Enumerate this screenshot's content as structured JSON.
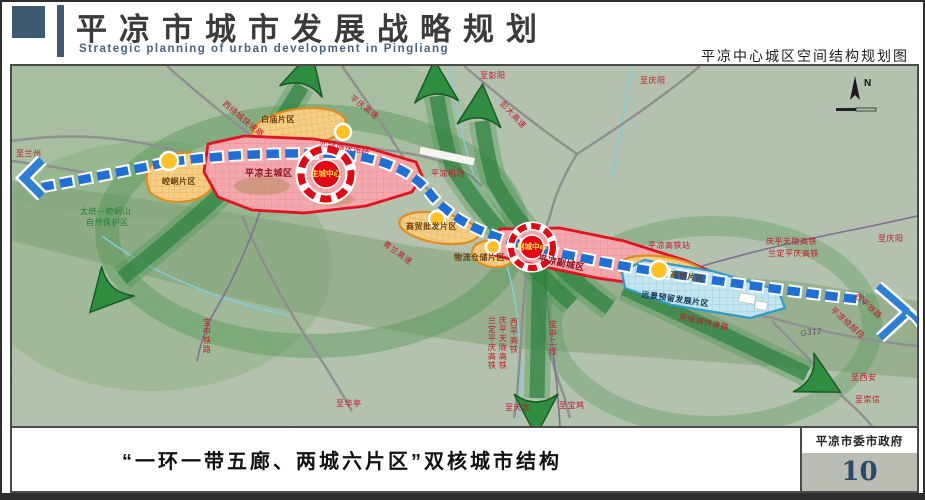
{
  "header": {
    "title": "平凉市城市发展战略规划",
    "subtitle_en": "Strategic planning of urban development in Pingliang",
    "right_caption": "平凉中心城区空间结构规划图"
  },
  "footer": {
    "caption": "“一环一带五廊、两城六片区”双核城市结构",
    "org": "平凉市委市政府",
    "page_number": "10"
  },
  "map": {
    "compass": "N",
    "colors": {
      "terrain": "#b6c4b0",
      "corridor_green": "#2e8d3e",
      "axis_blue": "#1f6fd6",
      "core_red": "#e30613",
      "zone_pink": "#f3a8ae",
      "zone_orange": "#f6cd84",
      "zone_blue": "#c2e5ee",
      "node_yellow": "#ffc125",
      "label_red": "#c2182b"
    },
    "labels": [
      {
        "t": "至兰州",
        "x": 4,
        "y": 84,
        "c": "red"
      },
      {
        "t": "太统—崆峒山",
        "x": 68,
        "y": 142,
        "c": "green"
      },
      {
        "t": "自然保护区",
        "x": 74,
        "y": 153,
        "c": "green"
      },
      {
        "t": "崆峒片区",
        "x": 150,
        "y": 112,
        "c": "zone"
      },
      {
        "t": "平凉主城区",
        "x": 233,
        "y": 103,
        "c": "city"
      },
      {
        "t": "主城中心",
        "x": 299,
        "y": 104,
        "c": "core"
      },
      {
        "t": "白庙片区",
        "x": 249,
        "y": 50,
        "c": "zone"
      },
      {
        "t": "西绕城快速路",
        "x": 214,
        "y": 34,
        "c": "red",
        "r": 40
      },
      {
        "t": "北绕城快速路",
        "x": 308,
        "y": 74,
        "c": "red",
        "r": 9
      },
      {
        "t": "平庆高速",
        "x": 341,
        "y": 28,
        "c": "red",
        "r": 38
      },
      {
        "t": "平凉机场",
        "x": 419,
        "y": 104,
        "c": "red"
      },
      {
        "t": "至彭阳",
        "x": 468,
        "y": 6,
        "c": "red"
      },
      {
        "t": "至庆阳",
        "x": 628,
        "y": 11,
        "c": "red"
      },
      {
        "t": "彭大高速",
        "x": 492,
        "y": 34,
        "c": "red",
        "r": 47
      },
      {
        "t": "青兰高速",
        "x": 374,
        "y": 174,
        "c": "red",
        "r": 36
      },
      {
        "t": "商贸批发片区",
        "x": 394,
        "y": 157,
        "c": "zone"
      },
      {
        "t": "物流仓储片区",
        "x": 442,
        "y": 188,
        "c": "zone"
      },
      {
        "t": "副城中心",
        "x": 505,
        "y": 177,
        "c": "core"
      },
      {
        "t": "平凉副城区",
        "x": 527,
        "y": 188,
        "c": "city",
        "r": 12
      },
      {
        "t": "平凉高铁站",
        "x": 636,
        "y": 176,
        "c": "red"
      },
      {
        "t": "庆平天陇高铁",
        "x": 754,
        "y": 172,
        "c": "red"
      },
      {
        "t": "兰定平庆高铁",
        "x": 756,
        "y": 184,
        "c": "red"
      },
      {
        "t": "至庆阳",
        "x": 866,
        "y": 169,
        "c": "red"
      },
      {
        "t": "高铁片区",
        "x": 659,
        "y": 205,
        "c": "zone",
        "r": 8
      },
      {
        "t": "远景预留发展片区",
        "x": 630,
        "y": 225,
        "c": "blue",
        "r": 8
      },
      {
        "t": "南绕城快速路",
        "x": 668,
        "y": 247,
        "c": "red",
        "r": 13
      },
      {
        "t": "G312",
        "x": 788,
        "y": 264,
        "c": "gray",
        "r": -7
      },
      {
        "t": "西平铁路",
        "x": 846,
        "y": 226,
        "c": "red",
        "r": 42
      },
      {
        "t": "平凉绕越段",
        "x": 822,
        "y": 240,
        "c": "red",
        "r": 42
      },
      {
        "t": "至西安",
        "x": 839,
        "y": 308,
        "c": "red"
      },
      {
        "t": "至崇信",
        "x": 843,
        "y": 330,
        "c": "red"
      },
      {
        "t": "至华亭",
        "x": 324,
        "y": 334,
        "c": "red"
      },
      {
        "t": "至天水",
        "x": 493,
        "y": 338,
        "c": "red"
      },
      {
        "t": "至宝鸡",
        "x": 547,
        "y": 336,
        "c": "red"
      },
      {
        "t": "宝中二线",
        "x": 536,
        "y": 254,
        "c": "red",
        "v": true
      },
      {
        "t": "西平高铁",
        "x": 497,
        "y": 252,
        "c": "red",
        "v": true
      },
      {
        "t": "庆平天陇高铁",
        "x": 486,
        "y": 250,
        "c": "red",
        "v": true
      },
      {
        "t": "兰定平庆高铁",
        "x": 475,
        "y": 250,
        "c": "red",
        "v": true
      },
      {
        "t": "宝中铁路",
        "x": 190,
        "y": 252,
        "c": "red",
        "v": true
      }
    ]
  }
}
